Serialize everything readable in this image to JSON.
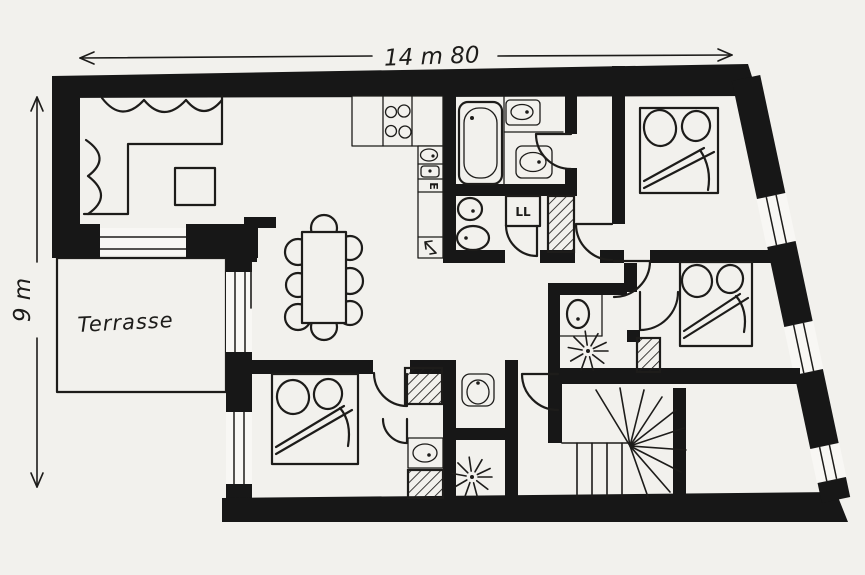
{
  "page": {
    "kind": "hand-drawn apartment floor plan sketch",
    "paper_color": "#f2f1ed",
    "ink_color": "#1d1c1a"
  },
  "dimensions": {
    "width_label": "14 m 80",
    "height_label": "9 m"
  },
  "labels": {
    "terrace": "Terrasse",
    "washing_machine": "LL",
    "kitchen_appliance": "E"
  },
  "fixtures": [
    "corner-sofa",
    "coffee-table",
    "pedestal-object",
    "dining-table-8-chairs",
    "kitchen-counter",
    "hob-4-burners",
    "kitchen-sink",
    "appliance-arrow",
    "bathtub",
    "washbasin",
    "toilet",
    "washing-machine",
    "laundry-duct",
    "shower",
    "double-bed-1",
    "double-bed-2",
    "double-bed-3",
    "winder-staircase",
    "terrace",
    "windows-in-slanted-wall"
  ]
}
